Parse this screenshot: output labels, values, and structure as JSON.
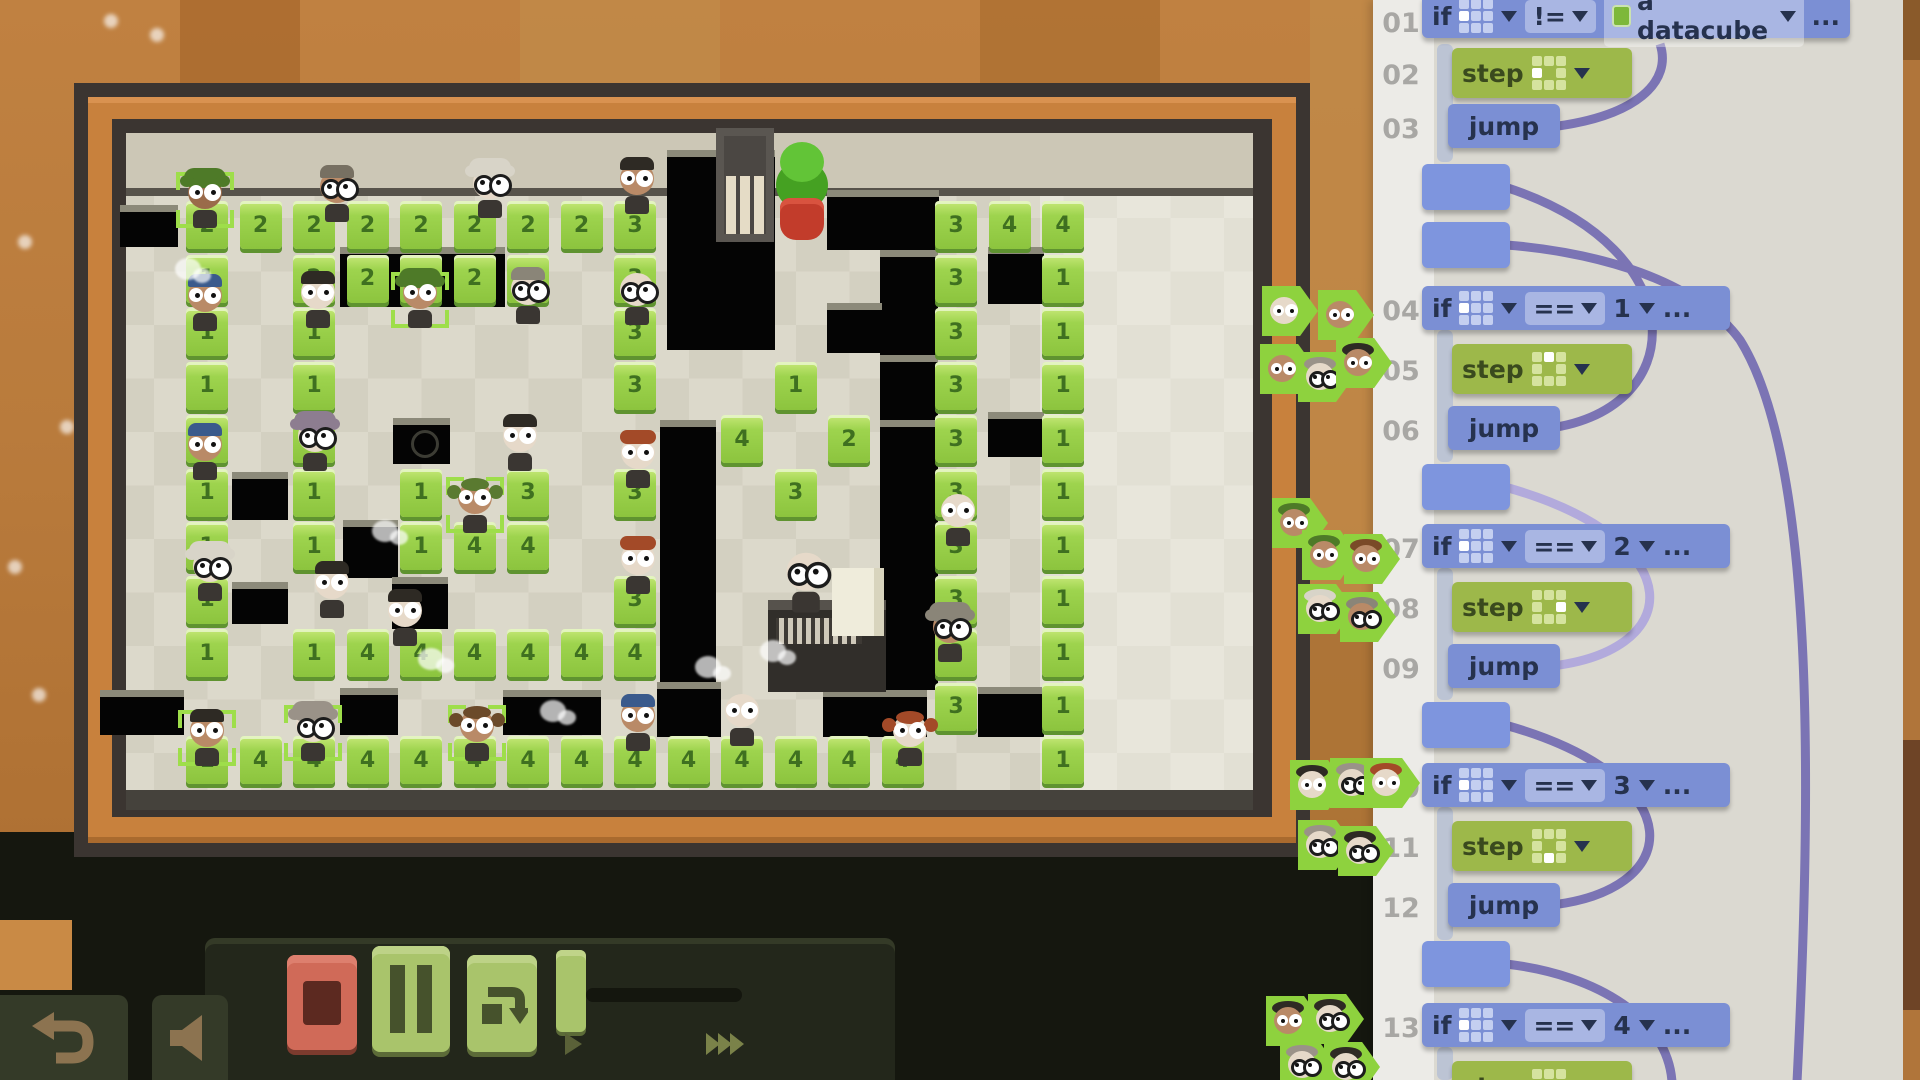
{
  "colors": {
    "accent_blue": "#7b8fd4",
    "accent_green": "#9db84a",
    "arc_purple": "#7b74b4",
    "arc_light": "#b2aadc",
    "cube_green": "#9ed44e",
    "selection_green": "#9ede4a",
    "stop_red": "#d06a58",
    "wood_orange": "#c8813d"
  },
  "code_panel": {
    "if_label": "if",
    "step_label": "step",
    "jump_label": "jump",
    "ellipsis": "...",
    "datacube_label": "a datacube",
    "gutter_numbers": [
      "01",
      "02",
      "03",
      "04",
      "05",
      "06",
      "07",
      "08",
      "09",
      "10",
      "11",
      "12",
      "13"
    ],
    "lines": [
      {
        "num": "01",
        "type": "if",
        "dir": "west",
        "op": "!=",
        "value": "a datacube"
      },
      {
        "num": "02",
        "type": "step",
        "dir": "west"
      },
      {
        "num": "03",
        "type": "jump"
      },
      {
        "num": "",
        "type": "tab"
      },
      {
        "num": "",
        "type": "tab"
      },
      {
        "num": "04",
        "type": "if",
        "dir": "west",
        "op": "==",
        "value": "1"
      },
      {
        "num": "05",
        "type": "step",
        "dir": "north"
      },
      {
        "num": "06",
        "type": "jump"
      },
      {
        "num": "",
        "type": "tab"
      },
      {
        "num": "07",
        "type": "if",
        "dir": "west",
        "op": "==",
        "value": "2"
      },
      {
        "num": "08",
        "type": "step",
        "dir": "east"
      },
      {
        "num": "09",
        "type": "jump"
      },
      {
        "num": "",
        "type": "tab"
      },
      {
        "num": "10",
        "type": "if",
        "dir": "west",
        "op": "==",
        "value": "3"
      },
      {
        "num": "11",
        "type": "step",
        "dir": "south"
      },
      {
        "num": "12",
        "type": "jump"
      },
      {
        "num": "",
        "type": "tab"
      },
      {
        "num": "13",
        "type": "if",
        "dir": "west",
        "op": "==",
        "value": "4"
      },
      {
        "num": "",
        "type": "step",
        "dir": "none"
      }
    ],
    "avatar_clusters": [
      {
        "name": "workers-at-line-04",
        "badges": [
          [
            1262,
            286,
            "pale",
            null,
            false
          ],
          [
            1318,
            290,
            "brown",
            null,
            false
          ],
          [
            1260,
            344,
            "brown",
            null,
            false
          ],
          [
            1298,
            352,
            "pale",
            "#9a9288",
            true
          ],
          [
            1336,
            338,
            "brown",
            "#2e2a24",
            false
          ]
        ]
      },
      {
        "name": "workers-at-line-07",
        "badges": [
          [
            1272,
            498,
            "brown",
            "#4e7a28",
            false
          ],
          [
            1302,
            530,
            "brown",
            "#4e7a28",
            false
          ],
          [
            1344,
            534,
            "brown",
            "#7a4a28",
            false
          ],
          [
            1298,
            584,
            "pale",
            "#d8d4c8",
            true
          ],
          [
            1340,
            592,
            "brown",
            "#8a8578",
            true
          ]
        ]
      },
      {
        "name": "workers-at-line-10",
        "badges": [
          [
            1290,
            760,
            "pale",
            "#2e2a24",
            false
          ],
          [
            1330,
            758,
            "pale",
            "#9a9288",
            true
          ],
          [
            1364,
            758,
            "pale",
            "#a34a28",
            false
          ],
          [
            1298,
            820,
            "pale",
            "#9a9288",
            true
          ],
          [
            1338,
            826,
            "pale",
            "#2e2a24",
            true
          ]
        ]
      },
      {
        "name": "workers-at-line-13",
        "badges": [
          [
            1266,
            996,
            "brown",
            "#2e2a24",
            false
          ],
          [
            1308,
            994,
            "pale",
            "#2e2a24",
            true
          ],
          [
            1280,
            1040,
            "pale",
            "#9a9288",
            true
          ],
          [
            1324,
            1042,
            "pale",
            "#2e2a24",
            true
          ]
        ]
      }
    ]
  },
  "world": {
    "grid": {
      "origin_x": 207,
      "origin_y": 217,
      "tile": 53.5
    },
    "cubes": [
      [
        0,
        0,
        2
      ],
      [
        1,
        0,
        2
      ],
      [
        2,
        0,
        2
      ],
      [
        3,
        0,
        2
      ],
      [
        4,
        0,
        2
      ],
      [
        5,
        0,
        2
      ],
      [
        6,
        0,
        2
      ],
      [
        7,
        0,
        2
      ],
      [
        8,
        0,
        3
      ],
      [
        14,
        0,
        3
      ],
      [
        15,
        0,
        4
      ],
      [
        16,
        0,
        4
      ],
      [
        0,
        1,
        1
      ],
      [
        2,
        1,
        2
      ],
      [
        3,
        1,
        2
      ],
      [
        4,
        1,
        2
      ],
      [
        5,
        1,
        2
      ],
      [
        6,
        1,
        3
      ],
      [
        8,
        1,
        3
      ],
      [
        14,
        1,
        3
      ],
      [
        16,
        1,
        1
      ],
      [
        0,
        2,
        1
      ],
      [
        2,
        2,
        1
      ],
      [
        8,
        2,
        3
      ],
      [
        14,
        2,
        3
      ],
      [
        16,
        2,
        1
      ],
      [
        0,
        3,
        1
      ],
      [
        2,
        3,
        1
      ],
      [
        8,
        3,
        3
      ],
      [
        11,
        3,
        1
      ],
      [
        14,
        3,
        3
      ],
      [
        16,
        3,
        1
      ],
      [
        0,
        4,
        1
      ],
      [
        2,
        4,
        1
      ],
      [
        10,
        4,
        4
      ],
      [
        12,
        4,
        2
      ],
      [
        14,
        4,
        3
      ],
      [
        16,
        4,
        1
      ],
      [
        0,
        5,
        1
      ],
      [
        2,
        5,
        1
      ],
      [
        4,
        5,
        1
      ],
      [
        6,
        5,
        3
      ],
      [
        8,
        5,
        3
      ],
      [
        11,
        5,
        3
      ],
      [
        14,
        5,
        3
      ],
      [
        16,
        5,
        1
      ],
      [
        0,
        6,
        1
      ],
      [
        2,
        6,
        1
      ],
      [
        4,
        6,
        1
      ],
      [
        5,
        6,
        4
      ],
      [
        6,
        6,
        4
      ],
      [
        14,
        6,
        3
      ],
      [
        16,
        6,
        1
      ],
      [
        0,
        7,
        1
      ],
      [
        8,
        7,
        3
      ],
      [
        14,
        7,
        3
      ],
      [
        16,
        7,
        1
      ],
      [
        0,
        8,
        1
      ],
      [
        2,
        8,
        1
      ],
      [
        3,
        8,
        4
      ],
      [
        4,
        8,
        4
      ],
      [
        5,
        8,
        4
      ],
      [
        6,
        8,
        4
      ],
      [
        7,
        8,
        4
      ],
      [
        8,
        8,
        4
      ],
      [
        14,
        8,
        3
      ],
      [
        16,
        8,
        1
      ],
      [
        14,
        9,
        3
      ],
      [
        16,
        9,
        1
      ],
      [
        0,
        10,
        1
      ],
      [
        1,
        10,
        4
      ],
      [
        2,
        10,
        4
      ],
      [
        3,
        10,
        4
      ],
      [
        4,
        10,
        4
      ],
      [
        5,
        10,
        4
      ],
      [
        6,
        10,
        4
      ],
      [
        7,
        10,
        4
      ],
      [
        8,
        10,
        4
      ],
      [
        9,
        10,
        4
      ],
      [
        10,
        10,
        4
      ],
      [
        11,
        10,
        4
      ],
      [
        12,
        10,
        4
      ],
      [
        13,
        10,
        4
      ],
      [
        16,
        10,
        1
      ]
    ],
    "pits": [
      [
        120,
        205,
        58,
        42
      ],
      [
        340,
        247,
        165,
        60
      ],
      [
        667,
        150,
        108,
        200
      ],
      [
        827,
        190,
        112,
        60
      ],
      [
        880,
        250,
        58,
        105
      ],
      [
        827,
        303,
        55,
        50
      ],
      [
        880,
        355,
        58,
        105
      ],
      [
        988,
        247,
        56,
        57
      ],
      [
        988,
        412,
        56,
        45
      ],
      [
        232,
        472,
        56,
        48
      ],
      [
        232,
        582,
        56,
        42
      ],
      [
        343,
        520,
        55,
        58
      ],
      [
        393,
        418,
        57,
        46
      ],
      [
        392,
        577,
        56,
        52
      ],
      [
        660,
        420,
        56,
        270
      ],
      [
        880,
        420,
        58,
        270
      ],
      [
        100,
        690,
        84,
        45
      ],
      [
        340,
        688,
        58,
        47
      ],
      [
        503,
        690,
        98,
        45
      ],
      [
        657,
        682,
        64,
        55
      ],
      [
        823,
        690,
        104,
        47
      ],
      [
        978,
        687,
        66,
        50
      ]
    ],
    "bug_pit": {
      "x": 393,
      "y": 418
    },
    "workers": [
      [
        205,
        200,
        "dark",
        "curly",
        "#4e7a28",
        false,
        true
      ],
      [
        337,
        194,
        "brown",
        "short",
        "#777062",
        true,
        false
      ],
      [
        490,
        190,
        "pale",
        "fluffy",
        "#d8d4c8",
        true,
        false
      ],
      [
        637,
        186,
        "brown",
        "short",
        "#2e2a24",
        false,
        false
      ],
      [
        205,
        303,
        "brown",
        "short",
        "#3a5a8c",
        false,
        false
      ],
      [
        318,
        300,
        "pale",
        "short",
        "#2e2a24",
        false,
        false
      ],
      [
        420,
        300,
        "brown",
        "curly",
        "#4e7a28",
        false,
        true
      ],
      [
        528,
        296,
        "pale",
        "short",
        "#8a8578",
        true,
        false
      ],
      [
        637,
        297,
        "pale",
        "bald",
        "#b5ab9c",
        true,
        false
      ],
      [
        205,
        452,
        "brown",
        "short",
        "#3a5a8c",
        false,
        false
      ],
      [
        315,
        443,
        "pale",
        "curly",
        "#8d7d90",
        true,
        false
      ],
      [
        520,
        443,
        "pale",
        "short",
        "#2e2a24",
        false,
        false
      ],
      [
        475,
        505,
        "brown",
        "pigtails",
        "#5a7a30",
        false,
        true
      ],
      [
        638,
        460,
        "pale",
        "bun",
        "#a34a28",
        false,
        false
      ],
      [
        958,
        518,
        "pale",
        "bald",
        "#c5bcac",
        false,
        false
      ],
      [
        638,
        566,
        "pale",
        "bun",
        "#a34a28",
        false,
        false
      ],
      [
        210,
        573,
        "pale",
        "fluffy",
        "#d8d4c8",
        true,
        false
      ],
      [
        332,
        590,
        "pale",
        "short",
        "#2e2a24",
        false,
        false
      ],
      [
        405,
        618,
        "pale",
        "short",
        "#2e2a24",
        false,
        false
      ],
      [
        950,
        634,
        "brown",
        "curly",
        "#8a8578",
        true,
        false
      ],
      [
        207,
        738,
        "brown",
        "short",
        "#2e2a24",
        false,
        true
      ],
      [
        313,
        733,
        "pale",
        "curly",
        "#9a9288",
        true,
        true
      ],
      [
        477,
        733,
        "brown",
        "pigtails",
        "#6b4a2a",
        false,
        true
      ],
      [
        638,
        723,
        "brown",
        "short",
        "#3a5a8c",
        false,
        false
      ],
      [
        742,
        718,
        "pale",
        "bald",
        "#d9d2c2",
        false,
        false
      ],
      [
        910,
        738,
        "pale",
        "pigtails",
        "#a34a28",
        false,
        false
      ]
    ],
    "smoke": [
      [
        372,
        520
      ],
      [
        418,
        648
      ],
      [
        695,
        656
      ],
      [
        175,
        258
      ],
      [
        540,
        700
      ],
      [
        760,
        640
      ]
    ],
    "manager": {
      "x": 806,
      "y": 580
    },
    "props": [
      "gate",
      "potted-plant",
      "manager-desk"
    ]
  },
  "controls": {
    "stop": "stop-button",
    "pause": "pause-button",
    "step_over": "step-over-button",
    "speed_slider": "speed-slider",
    "play": "play-marker",
    "fast_forward": "fast-forward-marker",
    "undo": "undo-button",
    "mute": "mute-button"
  }
}
